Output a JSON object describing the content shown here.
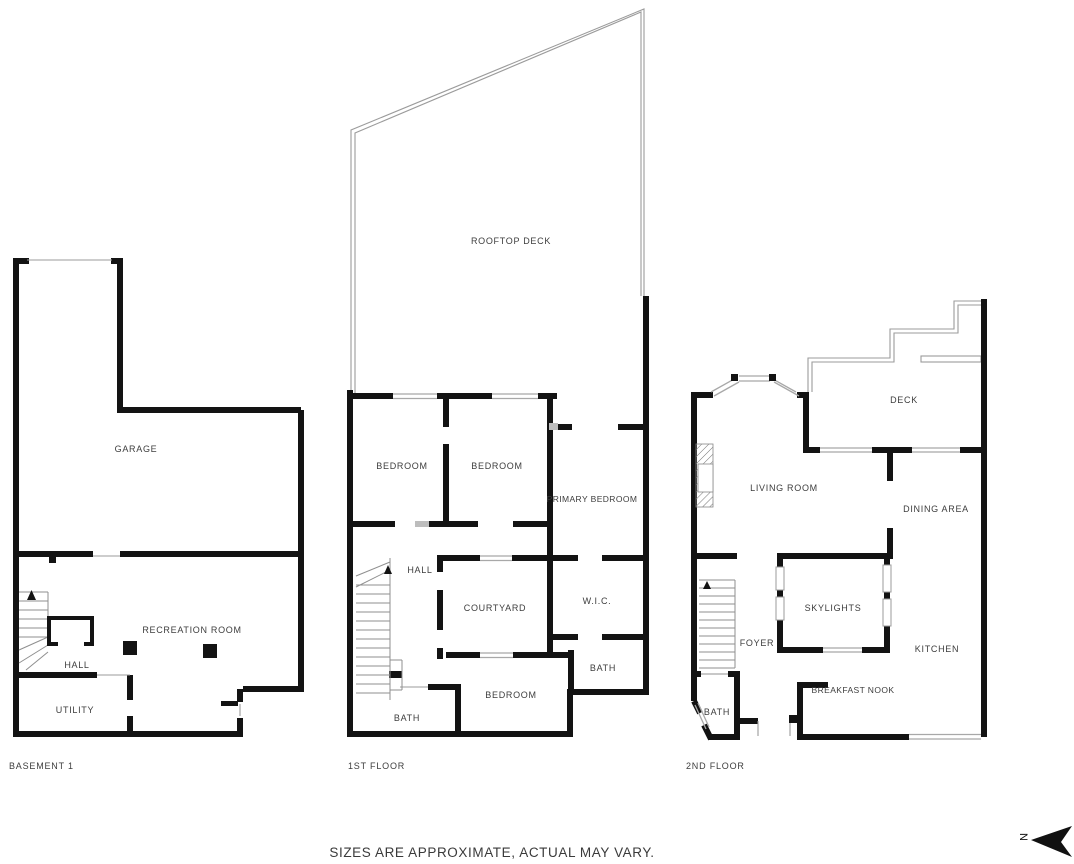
{
  "floors": [
    {
      "label": "BASEMENT 1",
      "rooms": {
        "garage": "GARAGE",
        "recreation_room": "RECREATION ROOM",
        "hall": "HALL",
        "utility": "UTILITY"
      }
    },
    {
      "label": "1ST FLOOR",
      "rooms": {
        "rooftop_deck": "ROOFTOP DECK",
        "bedroom_1": "BEDROOM",
        "bedroom_2": "BEDROOM",
        "primary_bedroom": "PRIMARY BEDROOM",
        "hall": "HALL",
        "courtyard": "COURTYARD",
        "wic": "W.I.C.",
        "bath_upper": "BATH",
        "bedroom_3": "BEDROOM",
        "bath_lower": "BATH"
      }
    },
    {
      "label": "2ND FLOOR",
      "rooms": {
        "deck": "DECK",
        "living_room": "LIVING ROOM",
        "dining_area": "DINING AREA",
        "skylights": "SKYLIGHTS",
        "foyer": "FOYER",
        "kitchen": "KITCHEN",
        "breakfast_nook": "BREAKFAST NOOK",
        "bath": "BATH"
      }
    }
  ],
  "disclaimer": "SIZES ARE APPROXIMATE, ACTUAL MAY VARY.",
  "compass": {
    "north_label": "N"
  },
  "colors": {
    "wall": "#131313",
    "thin_line": "#9b9b9b",
    "text": "#3d3d3d",
    "background": "#ffffff"
  }
}
